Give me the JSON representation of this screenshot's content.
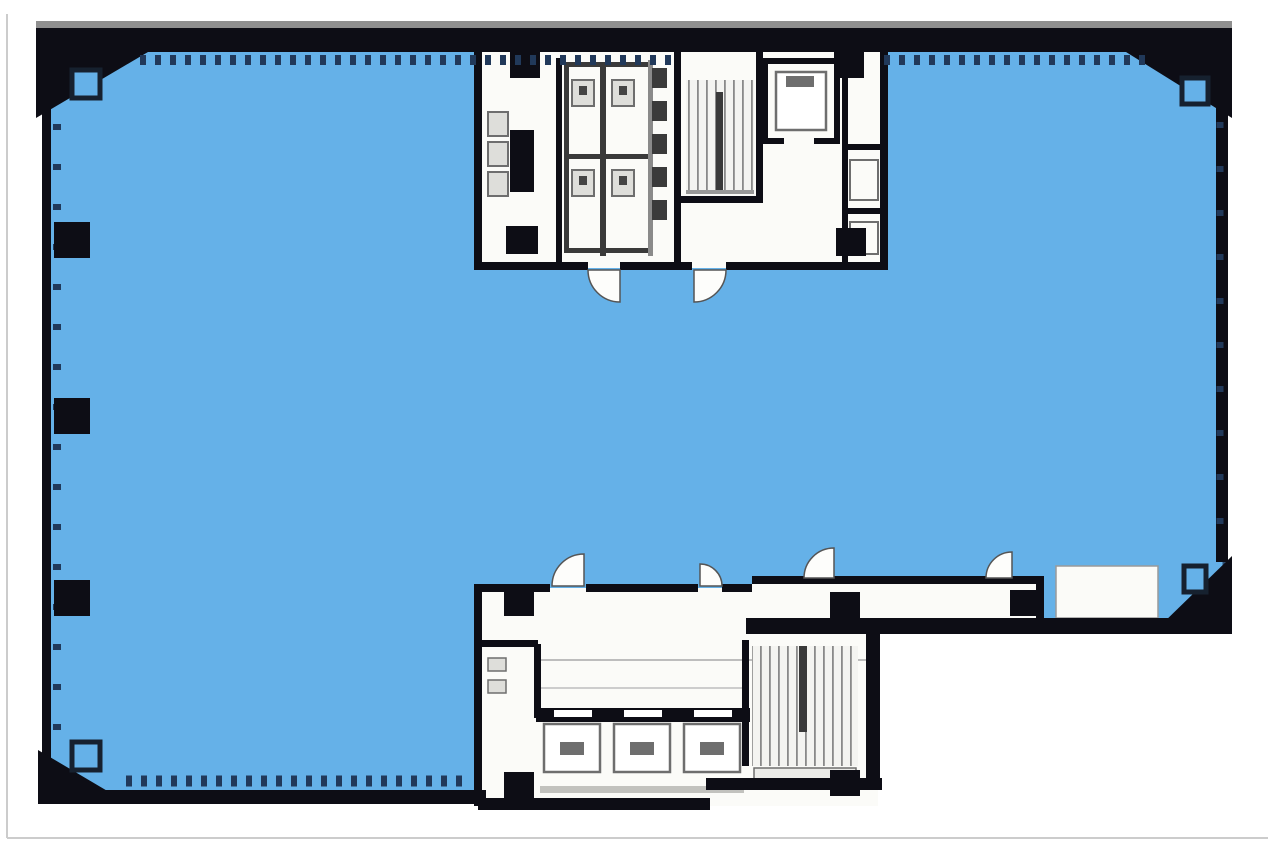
{
  "diagram": {
    "type": "architectural-floor-plan",
    "description": "office-building typical floor plate with leasable area shaded blue, a north service core (restrooms, stair, elevator) and a south elevator core with corridor",
    "colors": {
      "leasable_area": "#65B1E8",
      "area_outline": "#2B4D74",
      "wall": "#0D0D15",
      "wall_shadow": "#8F8F8F",
      "core_fill": "#FBFBF8",
      "fixture_stroke": "#6E6E6E",
      "fixture_fill": "#DEDEDA",
      "fixture_dark": "#3A3A3A",
      "window_mullion": "#21395A",
      "page_edge": "#CCCCCC"
    },
    "regions": [
      {
        "id": "leasable-office-area",
        "shade": "blue"
      },
      {
        "id": "north-service-core",
        "shade": "white"
      },
      {
        "id": "south-elevator-core",
        "shade": "white"
      },
      {
        "id": "south-corridor",
        "shade": "white"
      },
      {
        "id": "perimeter-balcony-notch",
        "shade": "white"
      }
    ],
    "features": {
      "south_elevator_count": 3,
      "north_elevator_count": 1,
      "staircase_count": 2,
      "toilet_stall_count": 4,
      "urinal_count": 5,
      "left_wall_column_count": 3,
      "chamfered_corner_count": 4
    }
  }
}
